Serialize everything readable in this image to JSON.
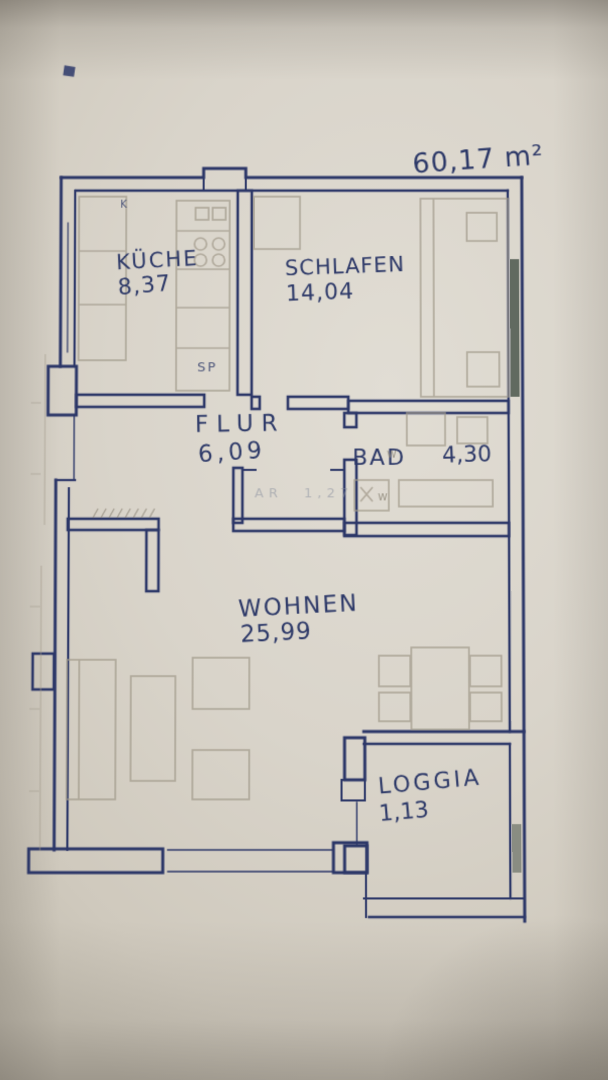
{
  "plan": {
    "total_area": "60,17 m²",
    "rooms": [
      {
        "name": "KÜCHE",
        "area": "8,37"
      },
      {
        "name": "SCHLAFEN",
        "area": "14,04"
      },
      {
        "name": "FLUR",
        "area": "6,09"
      },
      {
        "name": "BAD",
        "area": "4,30"
      },
      {
        "name": "WOHNEN",
        "area": "25,99"
      },
      {
        "name": "LOGGIA",
        "area": "1,13"
      },
      {
        "name": "AR",
        "area": "1,27"
      }
    ],
    "annotations": {
      "sink_mark": "SP",
      "kitchen_corner_mark": "K",
      "bad_mark": "w"
    },
    "colors": {
      "ink": "#2c3768",
      "pencil": "#a29a8b",
      "paper": "#d9d4ca",
      "window_mark": "#3e4a40"
    }
  }
}
